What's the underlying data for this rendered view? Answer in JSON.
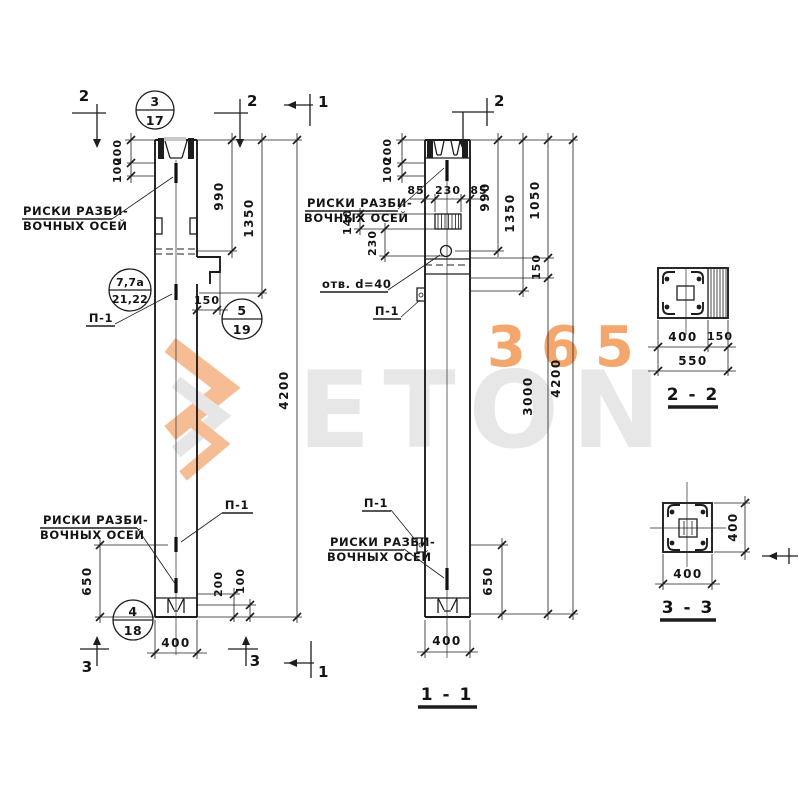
{
  "watermark": {
    "brand": "ETON",
    "number": "365"
  },
  "notes": {
    "axis1": "РИСКИ РАЗБИ-",
    "axis2": "ВОЧНЫХ ОСЕЙ",
    "plate": "П-1",
    "hole": "отв. d=40"
  },
  "sections": {
    "s11": "1 - 1",
    "s22": "2 - 2",
    "s33": "3 - 3"
  },
  "markers": {
    "m1": "1",
    "m2": "2",
    "m3": "3"
  },
  "callouts": {
    "c1": {
      "top": "3",
      "bot": "17"
    },
    "c2": {
      "top": "7,7а",
      "bot": "21,22"
    },
    "c3": {
      "top": "5",
      "bot": "19"
    },
    "c4": {
      "top": "4",
      "bot": "18"
    }
  },
  "dims": {
    "d85": "85",
    "d100": "100",
    "d140": "140",
    "d150": "150",
    "d200": "200",
    "d230": "230",
    "d400": "400",
    "d550": "550",
    "d650": "650",
    "d990": "990",
    "d1050": "1050",
    "d1350": "1350",
    "d3000": "3000",
    "d4200": "4200"
  }
}
